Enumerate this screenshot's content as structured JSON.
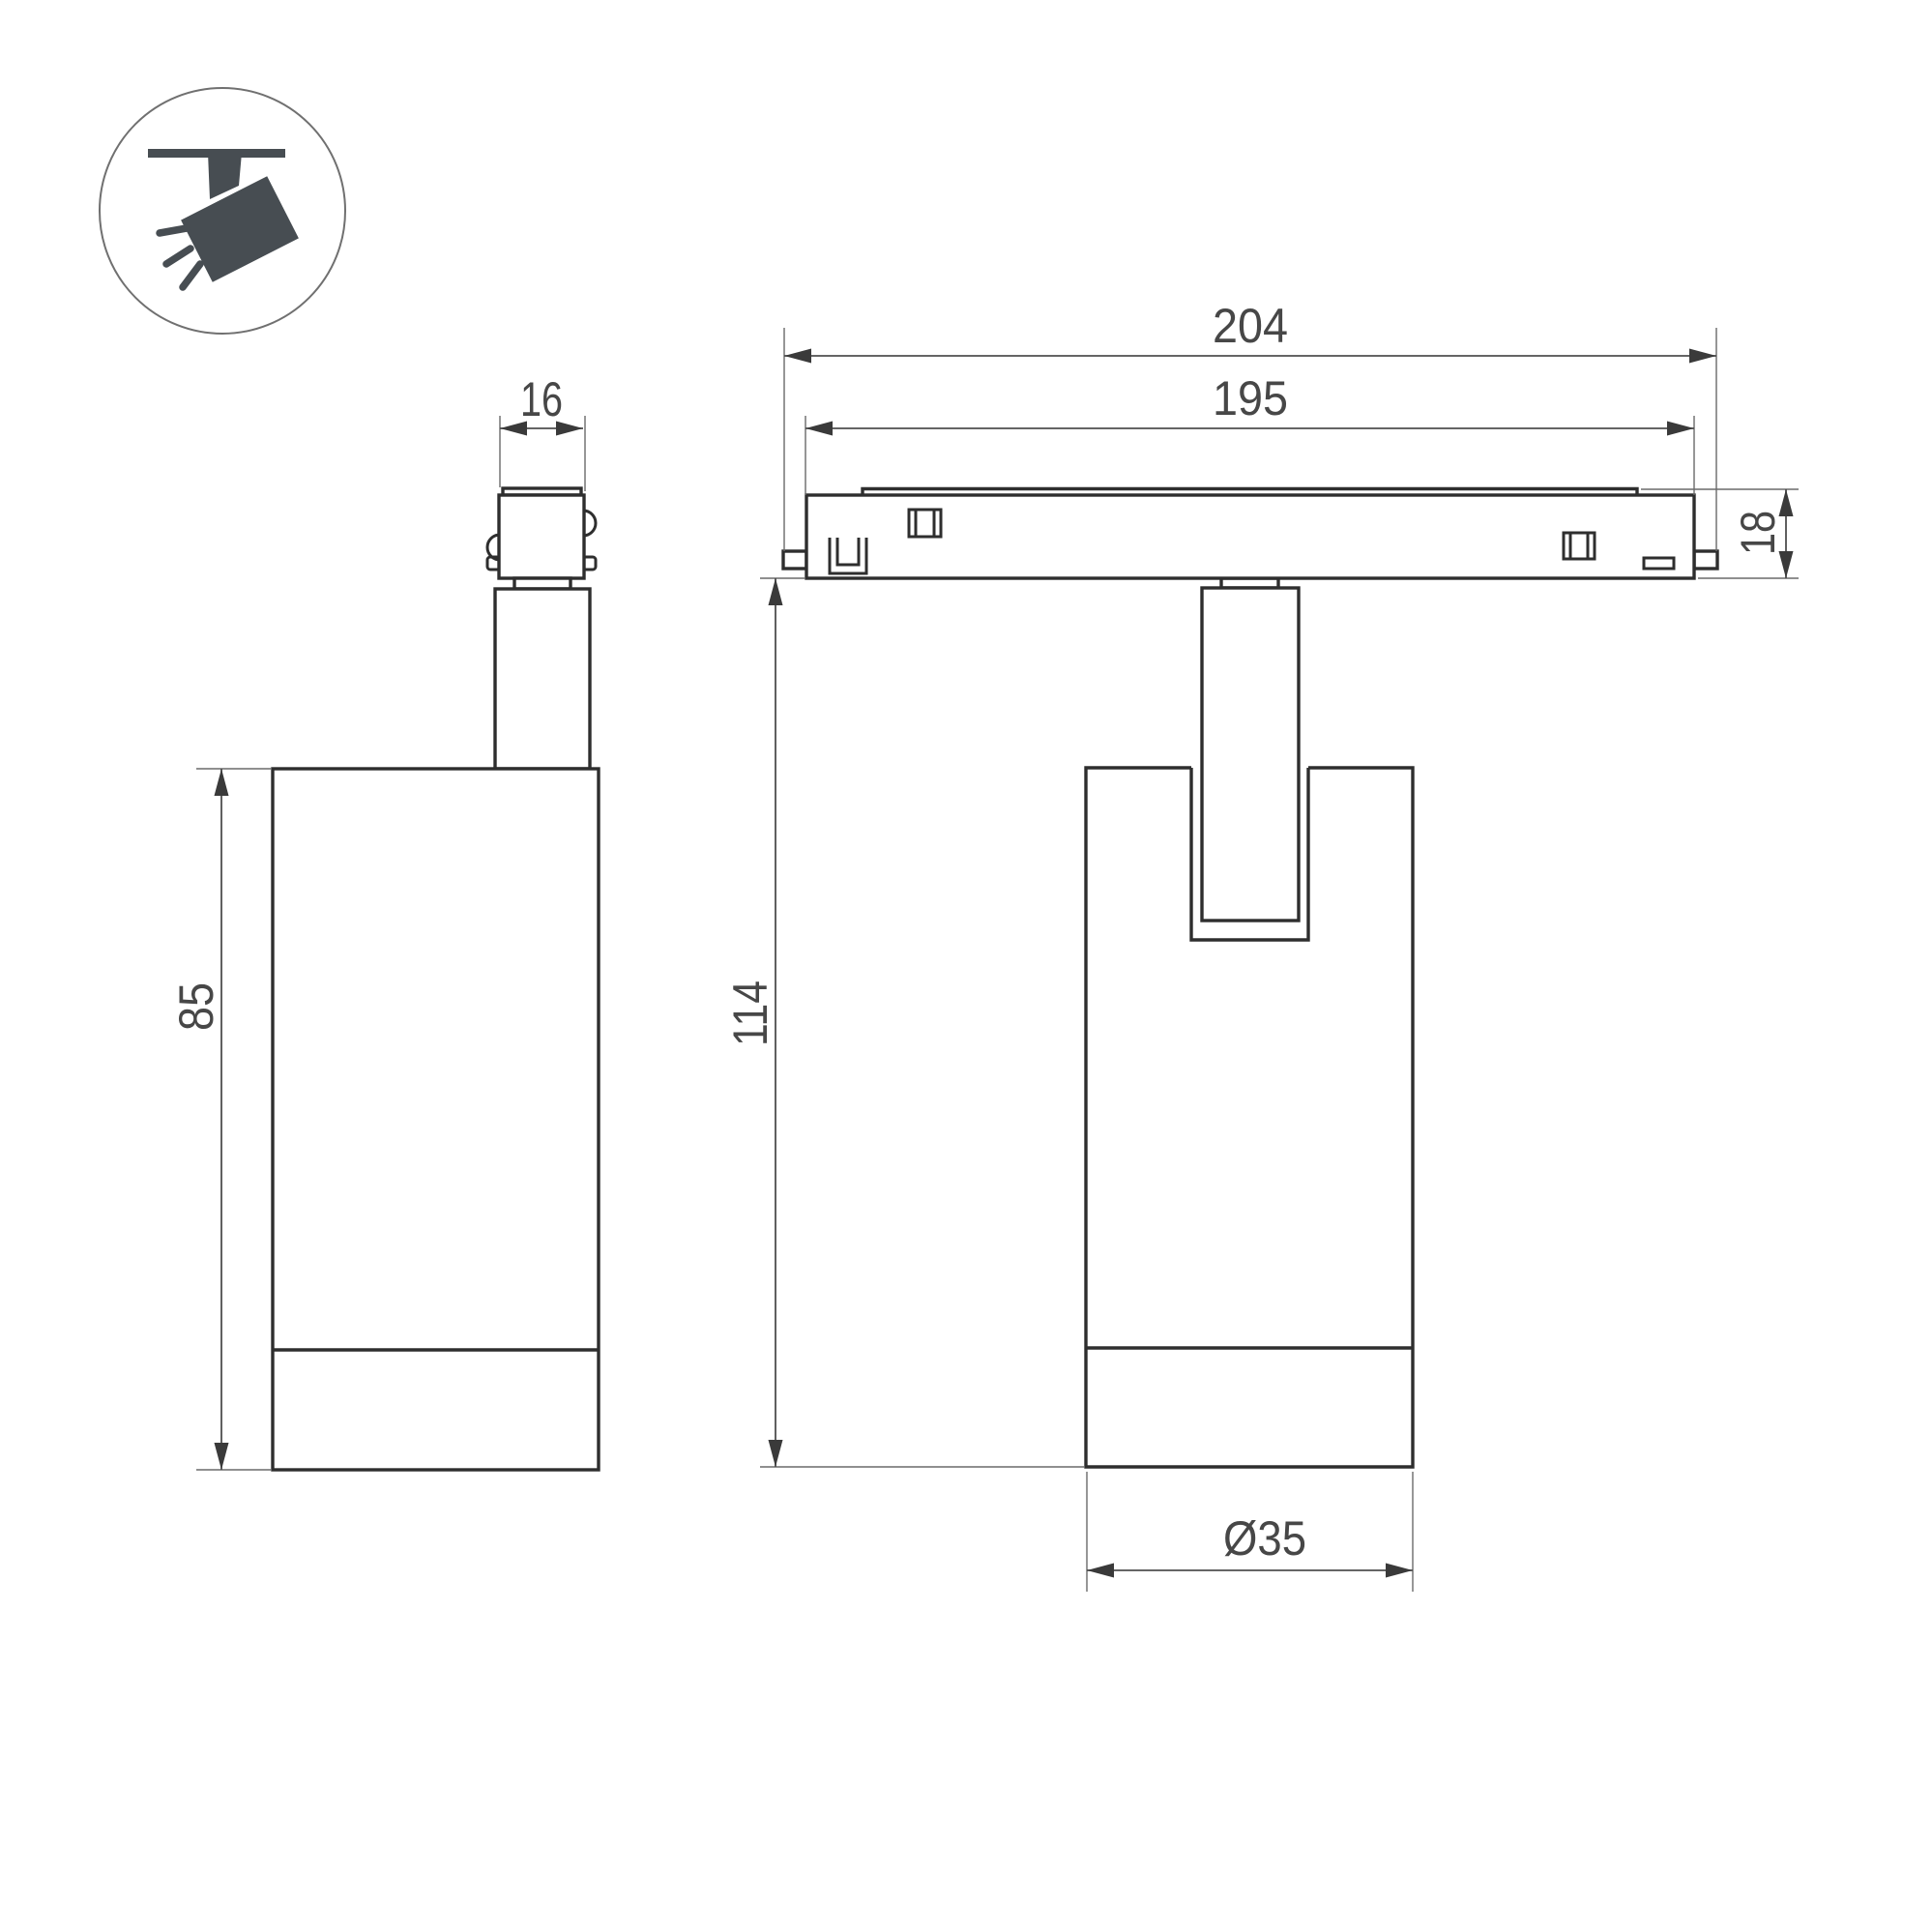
{
  "drawing": {
    "type": "luminaire-dimension-drawing",
    "background": "#ffffff",
    "outline_color": "#2e2e2e",
    "dimension_color": "#4f4f4f",
    "icon_color": "#474d52"
  },
  "icon": {
    "name": "track-spotlight-icon",
    "description": "ceiling track with tilted spotlight head and light rays"
  },
  "dimensions": {
    "side_view": {
      "adapter_width": "16",
      "body_height": "85"
    },
    "front_view": {
      "overall_length": "204",
      "rail_length": "195",
      "track_height": "18",
      "overall_height": "114",
      "body_diameter": "Ø35"
    }
  }
}
